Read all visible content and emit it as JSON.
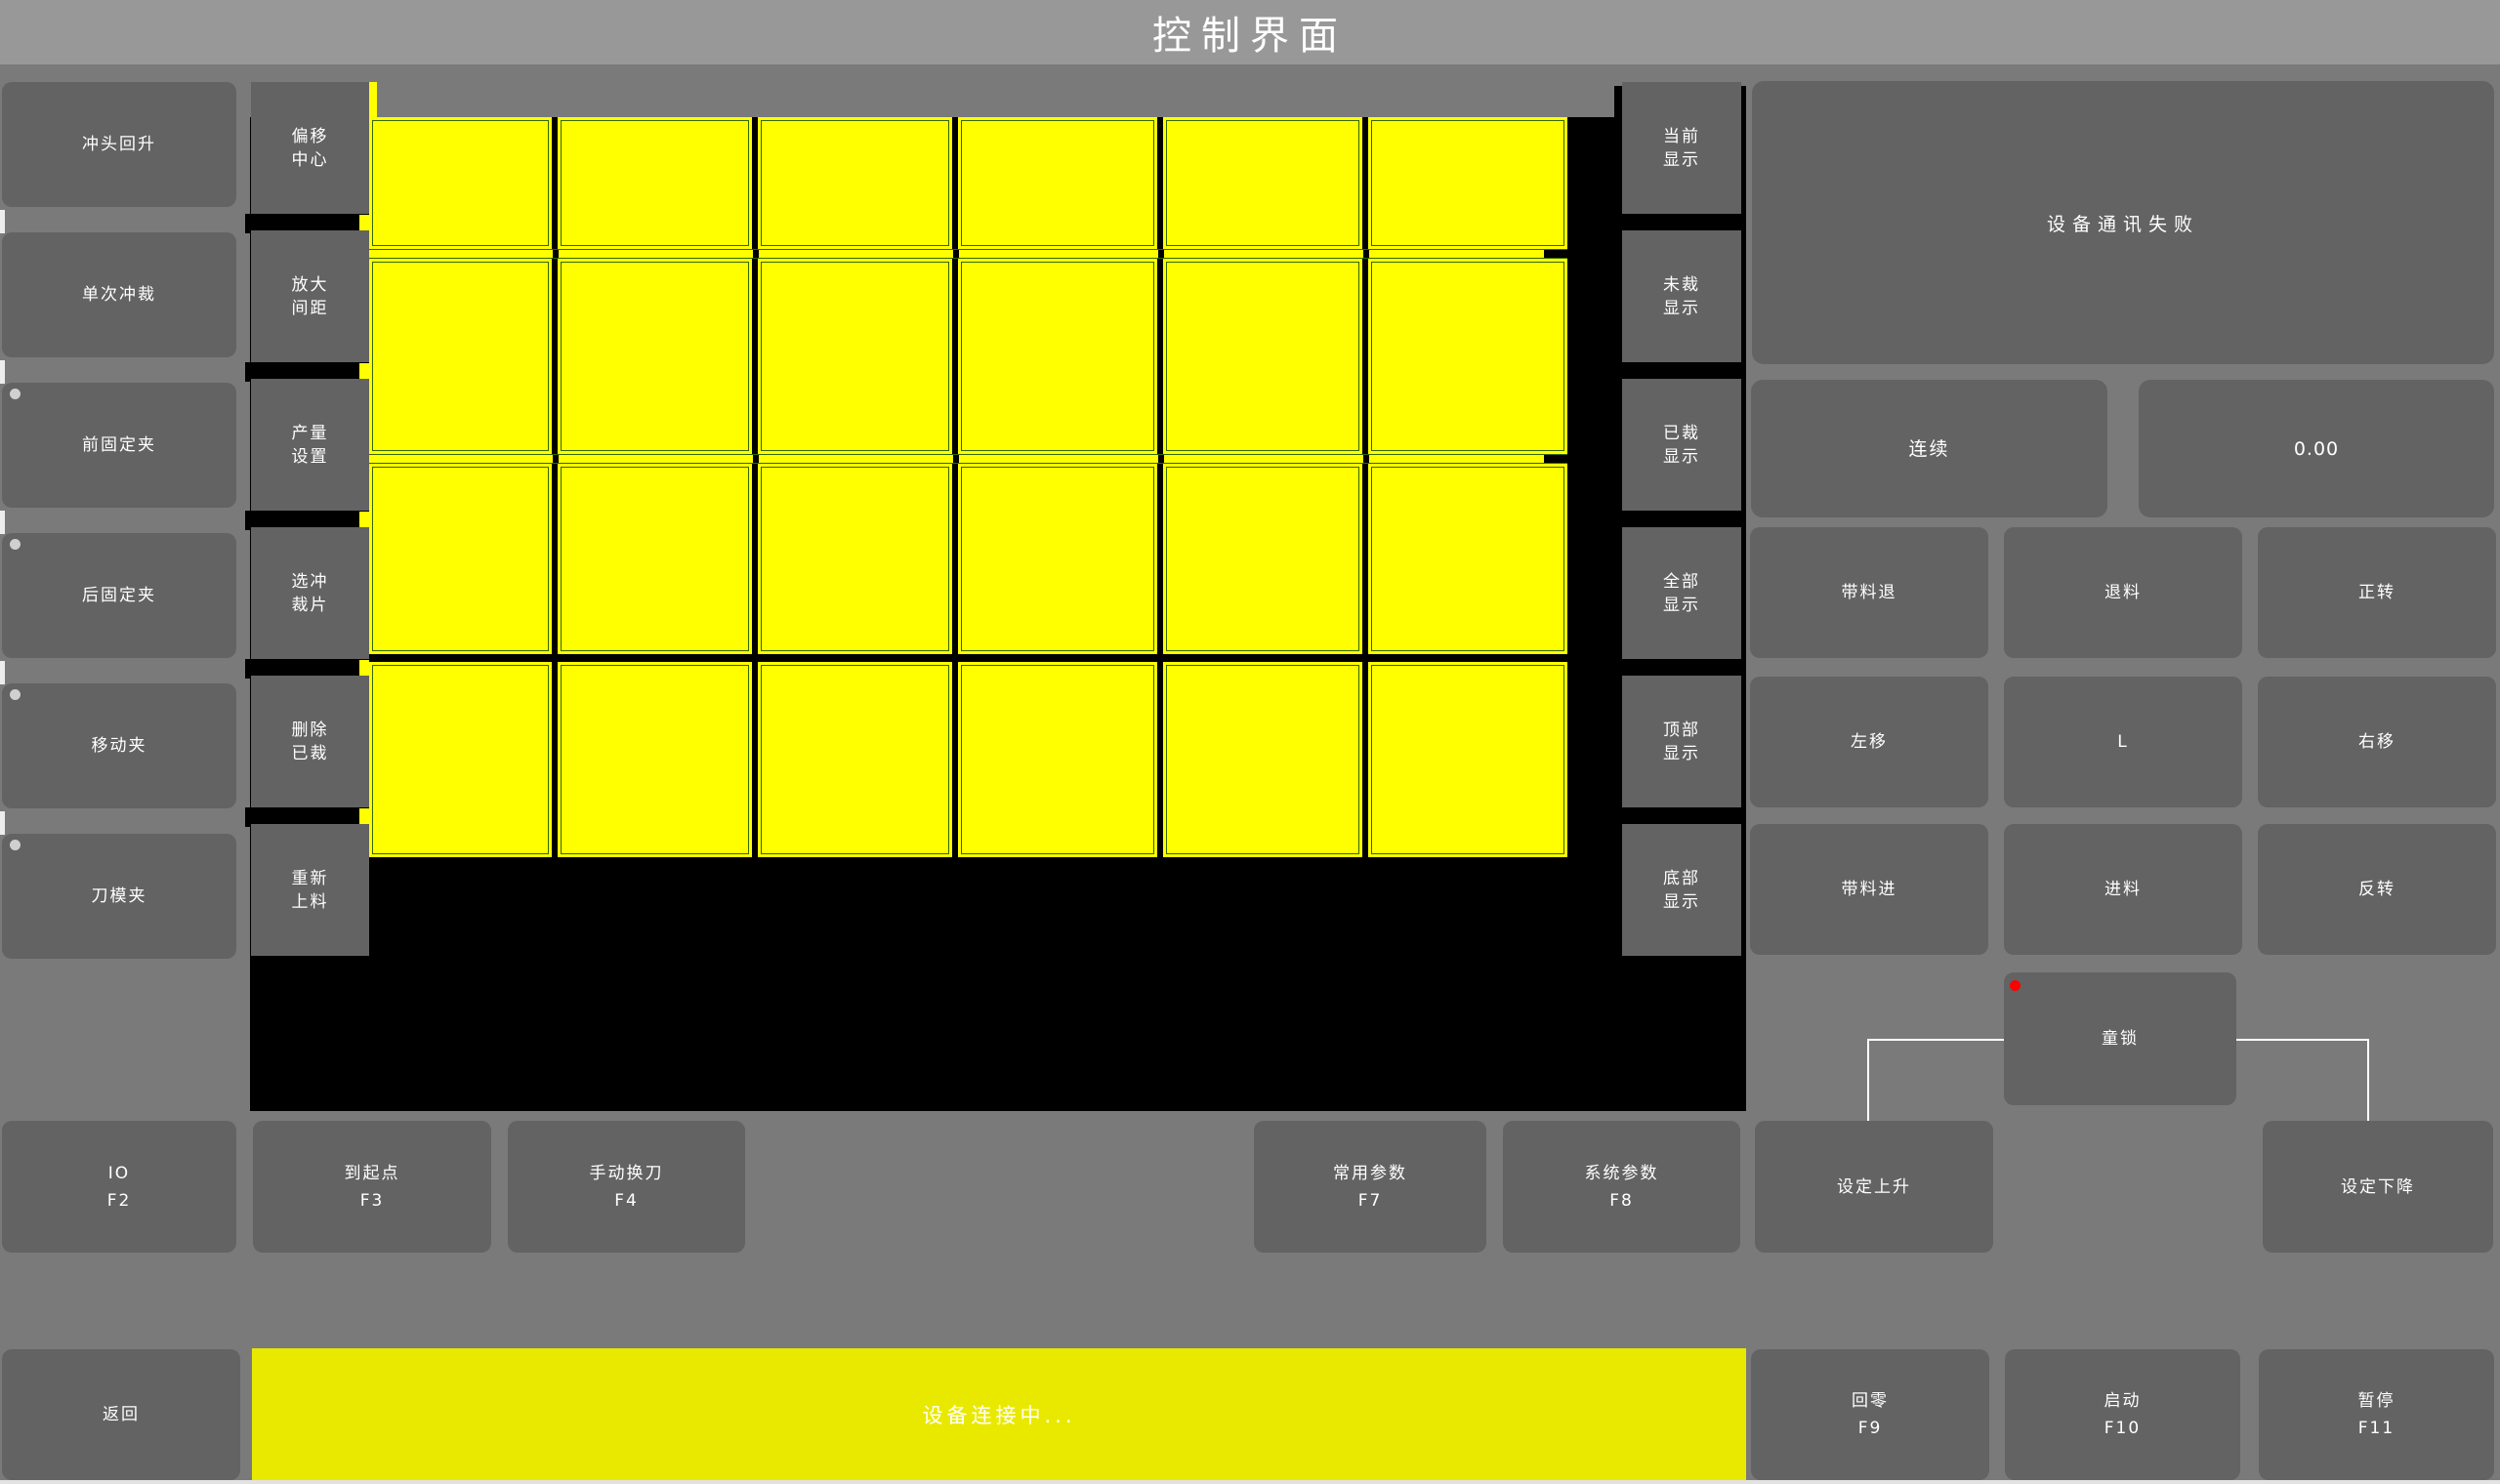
{
  "title": "控制界面",
  "colors": {
    "background": "#7a7a7a",
    "titlebar": "#989898",
    "button_gray": "#636363",
    "canvas_black": "#000000",
    "piece_yellow": "#ffff00",
    "piece_border_green": "#336600",
    "status_bar_yellow": "#e9e900",
    "alarm_red": "#ff0000",
    "text_white": "#ffffff"
  },
  "left_buttons": [
    {
      "label": "冲头回升",
      "dot": false
    },
    {
      "label": "单次冲裁",
      "dot": false
    },
    {
      "label": "前固定夹",
      "dot": true
    },
    {
      "label": "后固定夹",
      "dot": true
    },
    {
      "label": "移动夹",
      "dot": true
    },
    {
      "label": "刀模夹",
      "dot": true
    }
  ],
  "mid_buttons": [
    {
      "line1": "偏移",
      "line2": "中心"
    },
    {
      "line1": "放大",
      "line2": "间距"
    },
    {
      "line1": "产量",
      "line2": "设置"
    },
    {
      "line1": "选冲",
      "line2": "裁片"
    },
    {
      "line1": "删除",
      "line2": "已裁"
    },
    {
      "line1": "重新",
      "line2": "上料"
    }
  ],
  "display_buttons": [
    {
      "line1": "当前",
      "line2": "显示"
    },
    {
      "line1": "未裁",
      "line2": "显示"
    },
    {
      "line1": "已裁",
      "line2": "显示"
    },
    {
      "line1": "全部",
      "line2": "显示"
    },
    {
      "line1": "顶部",
      "line2": "显示"
    },
    {
      "line1": "底部",
      "line2": "显示"
    }
  ],
  "piece_grid": {
    "rows": 4,
    "cols": 6
  },
  "right_panel": {
    "message": "设备通讯失败",
    "continuous": "连续",
    "value": "0.00",
    "grid": [
      "带料退",
      "退料",
      "正转",
      "左移",
      "L",
      "右移",
      "带料进",
      "进料",
      "反转"
    ],
    "child_lock": "童锁"
  },
  "function_row": [
    {
      "label": "IO",
      "fkey": "F2"
    },
    {
      "label": "到起点",
      "fkey": "F3"
    },
    {
      "label": "手动换刀",
      "fkey": "F4"
    },
    {
      "label": "常用参数",
      "fkey": "F7"
    },
    {
      "label": "系统参数",
      "fkey": "F8"
    },
    {
      "label": "设定上升",
      "fkey": ""
    },
    {
      "label": "设定下降",
      "fkey": ""
    }
  ],
  "bottom_bar": {
    "back": "返回",
    "status": "设备连接中...",
    "buttons": [
      {
        "label": "回零",
        "fkey": "F9"
      },
      {
        "label": "启动",
        "fkey": "F10"
      },
      {
        "label": "暂停",
        "fkey": "F11"
      }
    ]
  }
}
